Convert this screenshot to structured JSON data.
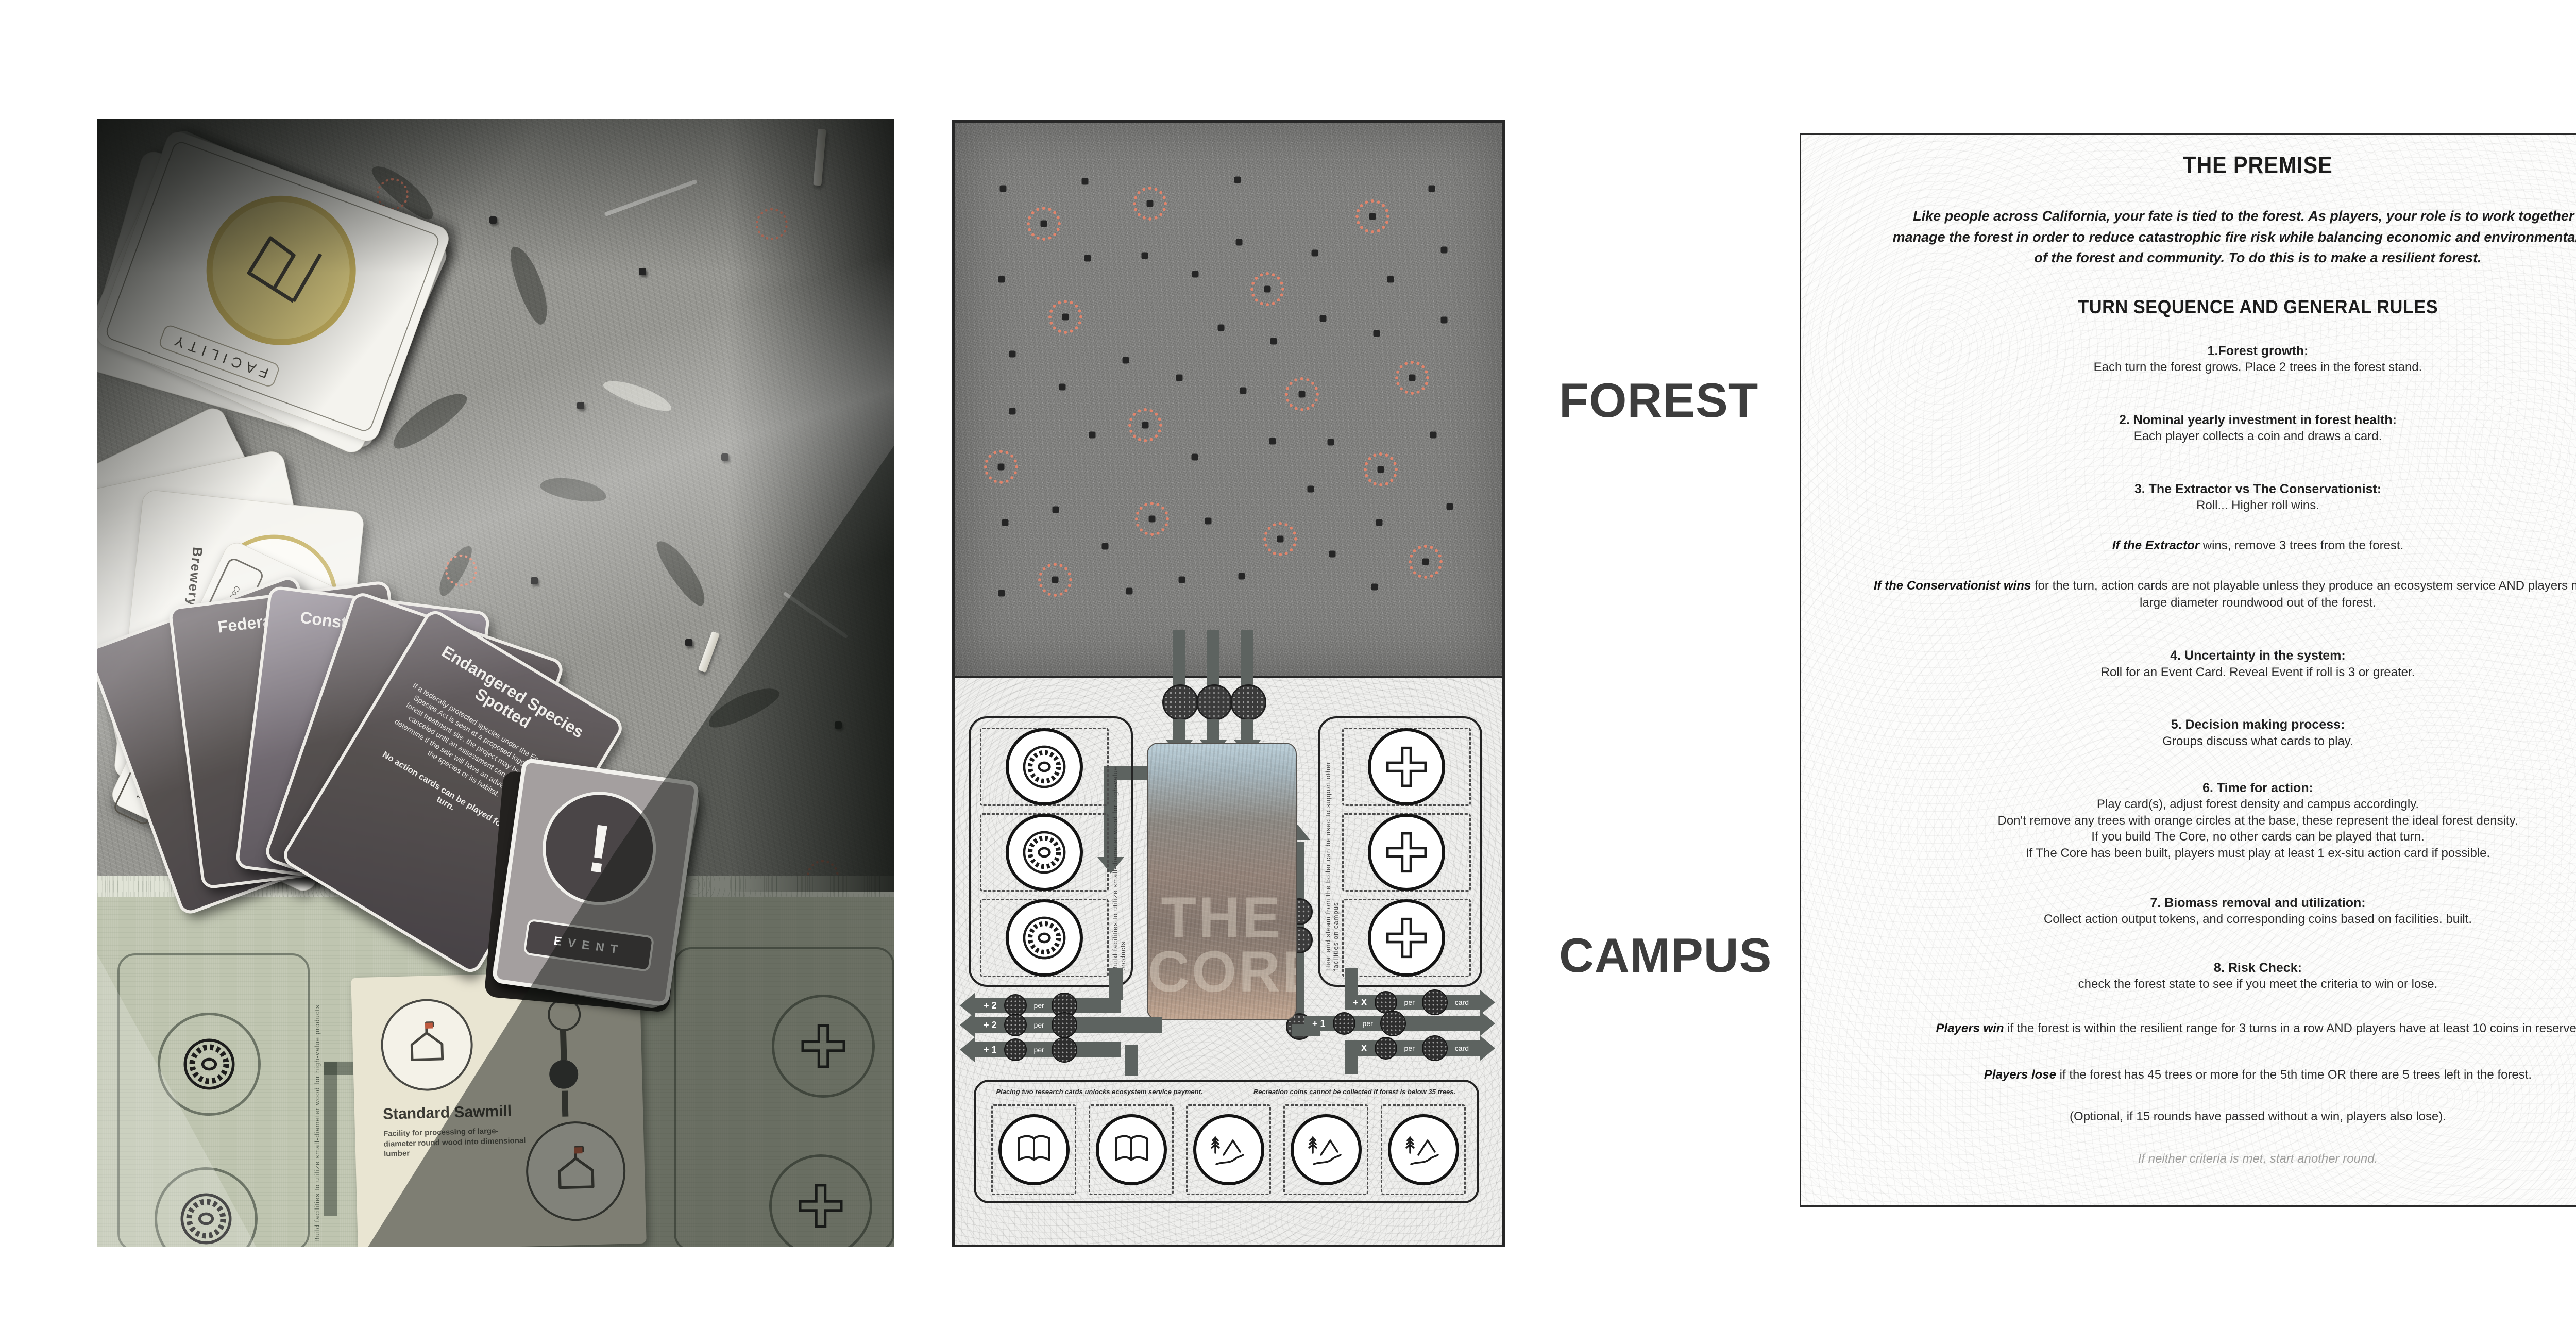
{
  "labels": {
    "forest": "FOREST",
    "campus": "CAMPUS"
  },
  "photo": {
    "facility_deck": {
      "label": "FACILITY"
    },
    "action_cards": {
      "front_title": "Camping Ground",
      "front_subtitle": "Outdoor area designed and equipped for camping with facilities such as tents, RV sites and campfires.",
      "second_title": "Brewery",
      "cost_label": "Cost",
      "cost_value": "2",
      "inputs_label": "Inputs",
      "outputs_label": "Outputs",
      "outputs_value": "1"
    },
    "dark_cards": {
      "back_title": "Federal Funding",
      "mid_title": "Construction Boom",
      "front_title": "Endangered Species Spotted",
      "front_body": "If a federally protected species under the Endangered Species Act is seen at a proposed logging sale or forest treatment site, the project may be delayed or canceled until an assessment can be made to determine if the sale will have an adverse impact on the species or its habitat.",
      "front_note": "No action cards can be played for one turn."
    },
    "event_deck": {
      "label": "EVENT",
      "glyph": "!"
    },
    "sawmill_card": {
      "title": "Standard Sawmill",
      "subtitle": "Facility for processing of large-diameter round wood into dimensional lumber"
    },
    "board_vertical_left": "Build facilities to utilize  small-diameter wood for high-value products"
  },
  "board": {
    "forest": {
      "tree_color": "#252525",
      "ideal_ring_color": "#e2846b",
      "trees": [
        [
          8.8,
          11.9
        ],
        [
          23.8,
          10.6
        ],
        [
          51.6,
          10.3
        ],
        [
          87.1,
          11.9
        ],
        [
          24.3,
          24.5
        ],
        [
          34.7,
          24.0
        ],
        [
          43.9,
          27.4
        ],
        [
          51.9,
          21.6
        ],
        [
          65.8,
          23.6
        ],
        [
          79.6,
          28.3
        ],
        [
          89.4,
          23.0
        ],
        [
          8.6,
          28.3
        ],
        [
          10.5,
          41.8
        ],
        [
          19.7,
          47.8
        ],
        [
          31.2,
          43.0
        ],
        [
          41.0,
          46.1
        ],
        [
          48.6,
          37.1
        ],
        [
          58.2,
          39.5
        ],
        [
          67.3,
          35.4
        ],
        [
          77.0,
          38.1
        ],
        [
          89.4,
          35.7
        ],
        [
          10.5,
          52.2
        ],
        [
          25.1,
          56.5
        ],
        [
          43.8,
          60.5
        ],
        [
          52.7,
          48.5
        ],
        [
          58.0,
          57.6
        ],
        [
          68.7,
          57.8
        ],
        [
          87.4,
          56.5
        ],
        [
          9.2,
          72.3
        ],
        [
          18.4,
          70.0
        ],
        [
          27.5,
          76.6
        ],
        [
          41.5,
          82.7
        ],
        [
          46.3,
          72.0
        ],
        [
          52.4,
          82.0
        ],
        [
          65.0,
          66.3
        ],
        [
          69.0,
          78.0
        ],
        [
          77.5,
          72.3
        ],
        [
          90.4,
          69.4
        ],
        [
          8.6,
          85.1
        ],
        [
          31.9,
          84.7
        ],
        [
          76.7,
          84.0
        ]
      ],
      "ideal_trees": [
        [
          35.7,
          14.6
        ],
        [
          16.3,
          18.3
        ],
        [
          76.3,
          17.0
        ],
        [
          20.2,
          35.1
        ],
        [
          57.1,
          30.1
        ],
        [
          8.5,
          62.3
        ],
        [
          34.8,
          54.7
        ],
        [
          63.4,
          49.1
        ],
        [
          83.5,
          46.1
        ],
        [
          77.8,
          62.7
        ],
        [
          36.0,
          71.7
        ],
        [
          59.5,
          75.3
        ],
        [
          86.0,
          79.4
        ],
        [
          18.3,
          82.7
        ]
      ]
    },
    "campus": {
      "core_title_line1": "THE",
      "core_title_line2": "CORE",
      "left_vertical_text": "Build facilities to utilize  small-diameter wood for high-value products",
      "right_vertical_text": "Heat and steam from the boiler can be used to support other facilities on campus",
      "left_payouts": [
        {
          "amount": "+ 2",
          "unit": "per"
        },
        {
          "amount": "+ 2",
          "unit": "per"
        },
        {
          "amount": "+ 1",
          "unit": "per"
        }
      ],
      "right_payouts": [
        {
          "amount": "+ X",
          "unit": "per",
          "suffix": "card"
        },
        {
          "amount": "+ 1",
          "unit": "per",
          "suffix": ""
        },
        {
          "amount": "+ X",
          "unit": "per",
          "suffix": "card"
        }
      ],
      "outputs_caption_left": "Placing two research cards unlocks ecosystem service payment.",
      "outputs_caption_right": "Recreation coins cannot be collected if forest is below 35 trees."
    }
  },
  "rules": {
    "title": "THE PREMISE",
    "premise": "Like people across California, your fate is tied to the forest. As players, your role is to work together and manage the forest in order to reduce catastrophic fire risk while balancing economic and environmental needs of the forest and community. To do this is to make a resilient forest.",
    "section_title": "TURN SEQUENCE AND GENERAL RULES",
    "items": [
      {
        "h": "1.Forest growth:",
        "b": "Each turn the forest grows. Place 2 trees in the forest stand."
      },
      {
        "h": "2. Nominal yearly investment in forest health:",
        "b": "Each player collects a coin and draws a card."
      },
      {
        "h": "3. The Extractor vs The Conservationist:",
        "b": "Roll... Higher roll wins."
      },
      {
        "lead": "If the Extractor",
        "b": " wins, remove 3 trees from the forest."
      },
      {
        "lead": "If the Conservationist wins",
        "b": " for the turn, action cards are not playable unless they produce an ecosystem service AND players may not take large diameter roundwood out of the forest."
      },
      {
        "h": "4. Uncertainty in the system:",
        "b": "Roll for an Event Card. Reveal Event if roll is 3 or greater."
      },
      {
        "h": "5. Decision making process:",
        "b": "Groups discuss what cards to play."
      },
      {
        "h": "6. Time for action:",
        "lines": [
          "Play card(s), adjust forest density and campus accordingly.",
          "Don't remove any trees with orange circles at the base, these represent the ideal forest density.",
          "If you build The Core, no other cards can be played that turn.",
          "If The Core has been built, players must play at least 1 ex-situ action card if possible."
        ]
      },
      {
        "h": "7. Biomass removal and utilization:",
        "b": "Collect action output tokens, and corresponding coins based on facilities. built."
      },
      {
        "h": "8. Risk Check:",
        "b": "check the forest state to see if you meet the criteria to win or lose."
      },
      {
        "lead": "Players win",
        "b": " if the forest is within the resilient range for 3 turns in a row AND players have at least 10 coins in reserve."
      },
      {
        "lead": "Players lose",
        "b": " if the forest has 45 trees or more for the 5th time OR there are 5 trees left in the forest."
      },
      {
        "b": "(Optional, if 15 rounds have passed without a win, players also lose)."
      }
    ],
    "footer": "If neither criteria is met, start another round."
  }
}
